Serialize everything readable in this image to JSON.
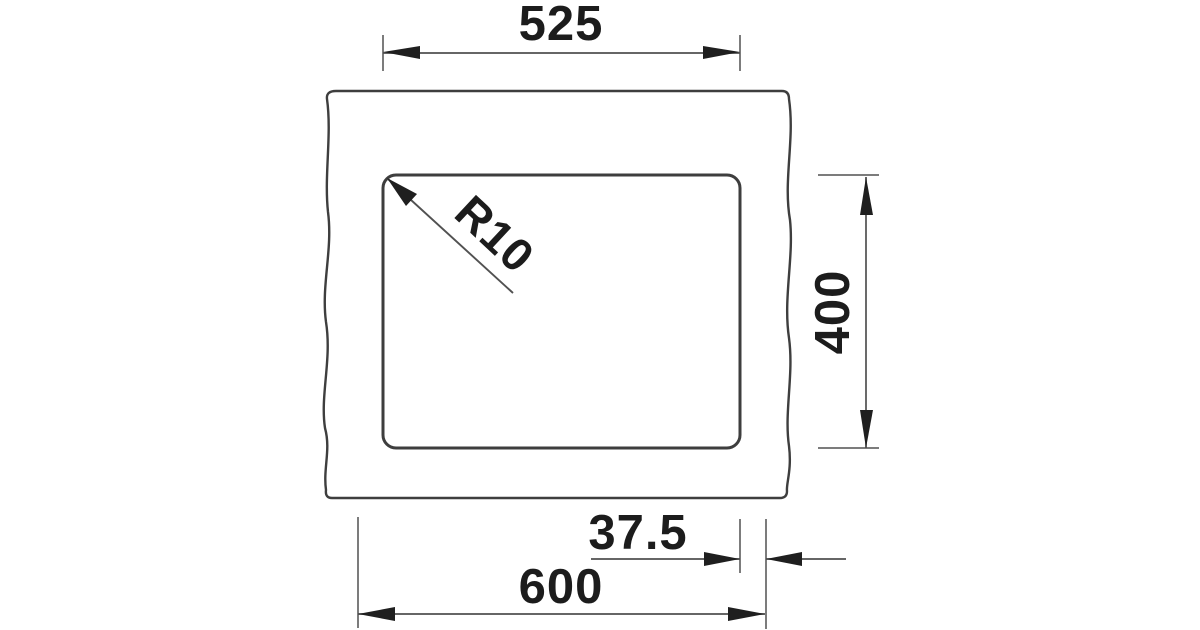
{
  "drawing": {
    "kind": "dimensioned-cutout-plan-view",
    "labels": {
      "bowl_width": "525",
      "bowl_depth": "400",
      "corner_radius": "R10",
      "edge_offset": "37.5",
      "cutout_width": "600"
    },
    "colors": {
      "background": "#ffffff",
      "outline": "#3e3e3e",
      "dim_line": "#515151",
      "accent": "#1f1f1f",
      "text": "#1c1c1c"
    }
  }
}
